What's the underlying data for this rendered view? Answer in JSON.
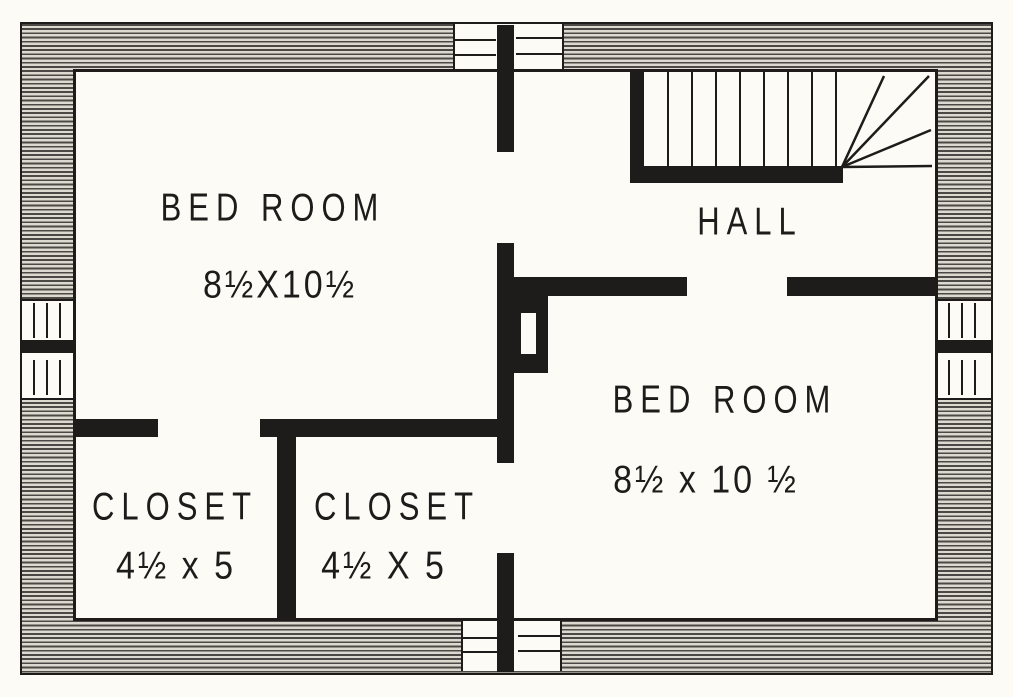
{
  "colors": {
    "ink": "#1e1c1a",
    "paper": "#fcfbf6",
    "hatch_dark": "#4b4945",
    "hatch_light": "#dcd9d1"
  },
  "rooms": {
    "bedroom_left": {
      "label": "BED ROOM",
      "dimensions": "8½X10½"
    },
    "hall": {
      "label": "HALL"
    },
    "bedroom_right": {
      "label": "BED ROOM",
      "dimensions": "8½ x 10 ½"
    },
    "closet_left": {
      "label": "CLOSET",
      "dimensions": "4½ x 5"
    },
    "closet_right": {
      "label": "CLOSET",
      "dimensions": "4½ X 5"
    }
  },
  "features": {
    "stairs": {
      "straight_treads": 8,
      "winder_treads": 4
    },
    "windows": {
      "top": 1,
      "bottom": 1,
      "left": 1,
      "right": 1
    },
    "chimney_flues": 1
  }
}
